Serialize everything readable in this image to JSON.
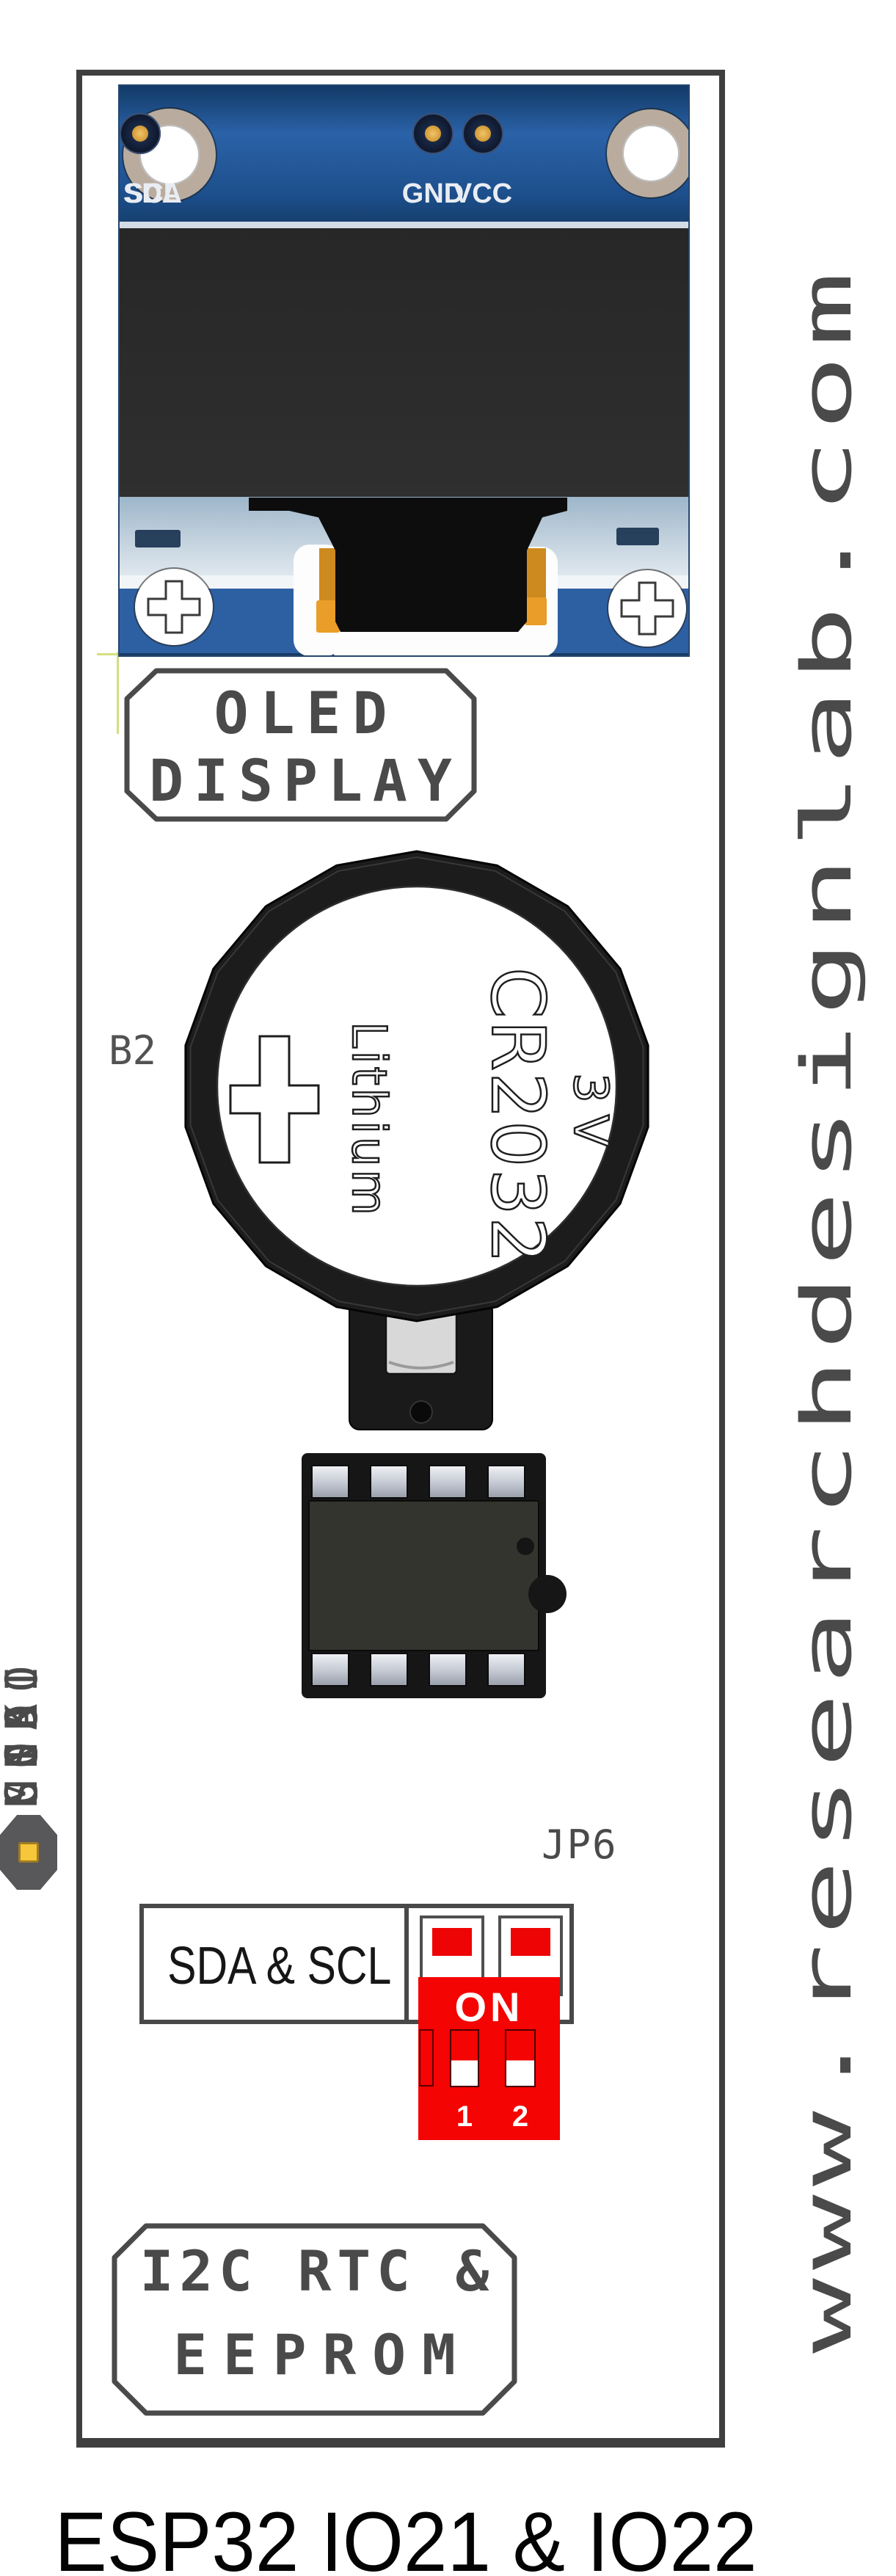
{
  "watermark": {
    "text": "www.researchdesignlab.com"
  },
  "caption": {
    "text": "ESP32 IO21 & IO22"
  },
  "oled": {
    "pins": [
      "GND",
      "VCC",
      "SCL",
      "SDA"
    ],
    "label": {
      "line1": "OLED",
      "line2": "DISPLAY"
    }
  },
  "battery": {
    "designator": "B2",
    "polarity": "+",
    "chemistry": "Lithium",
    "model": "CR2032",
    "voltage": "3V"
  },
  "header": {
    "designator": "JP6",
    "pins": [
      "CS",
      "MISO",
      "MOSI",
      "SCK",
      "GND",
      "SDA",
      "SCL"
    ]
  },
  "jumper": {
    "label": "SDA & SCL",
    "switches": [
      "1",
      "2"
    ]
  },
  "dip": {
    "label": "ON",
    "switches": [
      "1",
      "2"
    ]
  },
  "bottom_label": {
    "line1": "I2C RTC &",
    "line2": "EEPROM"
  },
  "colors": {
    "frame_gray": "#3f3f3f",
    "label_gray": "#4a4a4a",
    "pcb_blue": "#2a62a8",
    "dip_red": "#f40402",
    "switch_red": "#ee0404",
    "pad_gold": "#f6c63b",
    "battery_black": "#1c1c1c"
  }
}
